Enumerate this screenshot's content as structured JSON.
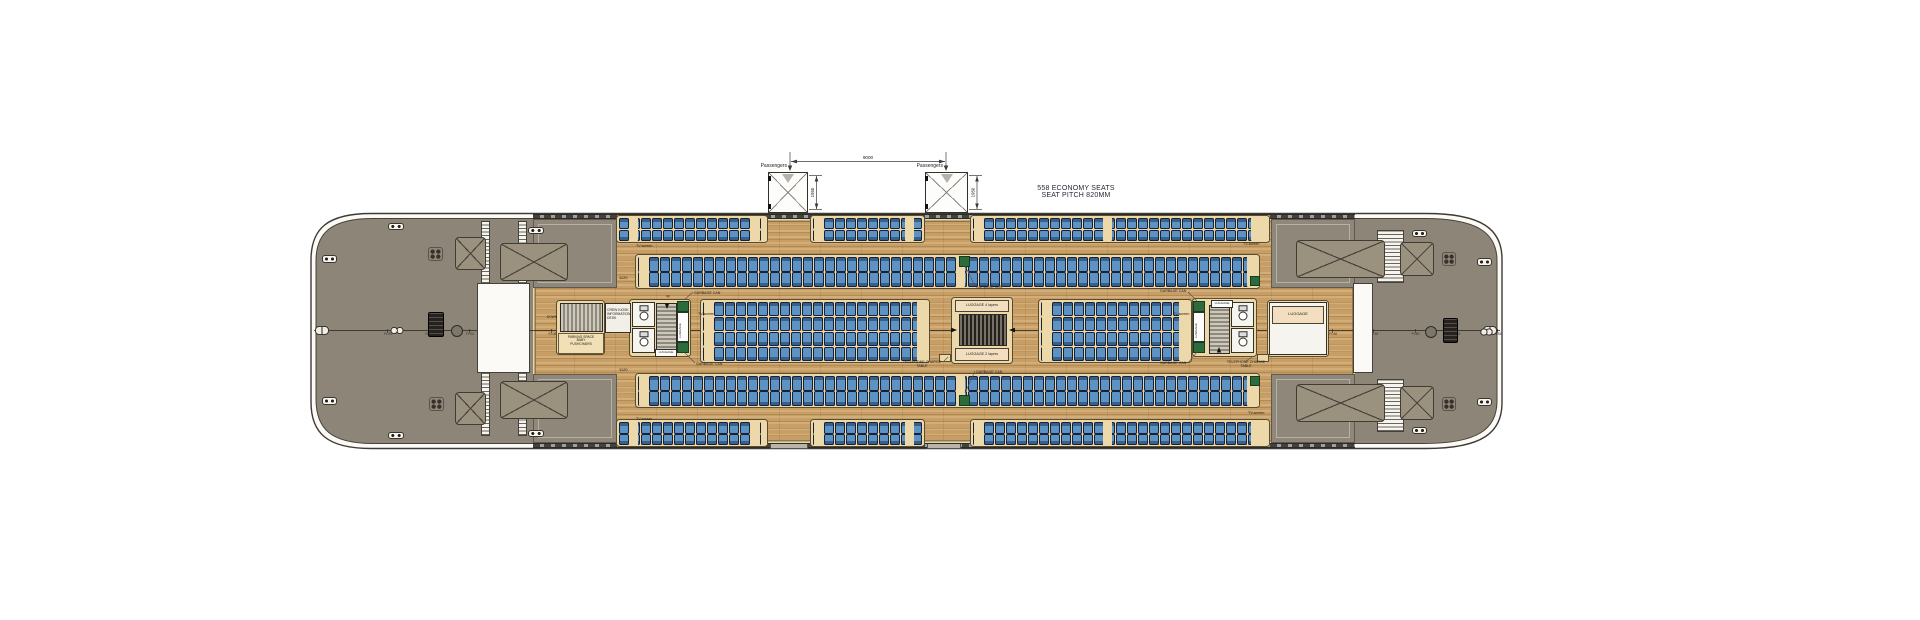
{
  "title": {
    "line1": "558 ECONOMY SEATS",
    "line2": "SEAT PITCH 820MM"
  },
  "dims": {
    "gangway_span": "9000",
    "door_width_left": "1950",
    "door_width_right": "1950",
    "passengers_left": "Passengers",
    "passengers_right": "Passengers",
    "row_offset_top": "1120",
    "row_offset_bottom": "1120"
  },
  "colors": {
    "deck_gray": "#8d8577",
    "wood": "#c79e66",
    "wood_trim": "#e9d6a6",
    "seat_blue": "#5d92c4",
    "seat_backrest": "#37618c",
    "seat_outline": "#16213a",
    "platform_cream": "#ecd8a8",
    "luggage_green": "#2c6b3c",
    "hull_line": "#3f3a33",
    "annotation": "#23211c"
  },
  "frames": {
    "prefix": "Fr.",
    "start": 0,
    "end": 54,
    "step": 2,
    "x0": 387,
    "pitch": 20.55,
    "tick_y": 328.6,
    "label_y": 331.8
  },
  "plan": {
    "canvas": {
      "w": 1920,
      "h": 620
    },
    "centerline": {
      "x": 314,
      "y": 330.3,
      "w": 1186
    },
    "wood_main": [
      533,
      219,
      822,
      224
    ],
    "corner_blocks": [
      [
        533,
        219,
        84,
        69
      ],
      [
        533,
        374,
        84,
        69
      ],
      [
        1271,
        219,
        84,
        69
      ],
      [
        1271,
        374,
        84,
        69
      ]
    ],
    "walls": [
      [
        533,
        213.5,
        822,
        5.5
      ],
      [
        533,
        442.5,
        822,
        5.5
      ]
    ],
    "towers": [
      {
        "x": 768,
        "y": 172,
        "w": 40,
        "h": 41
      },
      {
        "x": 925,
        "y": 172,
        "w": 43,
        "h": 41
      }
    ],
    "white_bands": [
      [
        477,
        283,
        53,
        90
      ],
      [
        1353,
        283,
        20,
        90
      ]
    ],
    "ladders": [
      [
        481,
        221,
        9,
        63
      ],
      [
        518,
        221,
        9,
        63
      ],
      [
        481,
        372,
        9,
        64
      ],
      [
        518,
        372,
        9,
        64
      ],
      [
        1377,
        230,
        27,
        53
      ],
      [
        1377,
        379,
        27,
        53
      ]
    ],
    "hatches": [
      [
        455,
        237,
        31,
        33
      ],
      [
        455,
        392,
        31,
        33
      ],
      [
        500,
        243,
        68,
        38
      ],
      [
        500,
        381,
        68,
        38
      ],
      [
        1296,
        240,
        89,
        38
      ],
      [
        1296,
        384,
        89,
        38
      ],
      [
        1400,
        242,
        34,
        34
      ],
      [
        1400,
        386,
        34,
        34
      ]
    ],
    "vents": [
      [
        428,
        247,
        15,
        14
      ],
      [
        429,
        397,
        15,
        14
      ],
      [
        1442,
        252,
        14,
        14
      ],
      [
        1442,
        397,
        14,
        14
      ]
    ],
    "cleats": [
      [
        322,
        255,
        15,
        8
      ],
      [
        322,
        397,
        15,
        8
      ],
      [
        388,
        223,
        16,
        7
      ],
      [
        528,
        227,
        16,
        7
      ],
      [
        388,
        432,
        16,
        7
      ],
      [
        528,
        430,
        16,
        7
      ],
      [
        1412,
        230,
        15,
        7
      ],
      [
        1477,
        258,
        15,
        8
      ],
      [
        1477,
        398,
        15,
        8
      ],
      [
        1412,
        427,
        15,
        7
      ]
    ],
    "fairleads": [
      [
        315,
        326,
        14,
        9
      ],
      [
        1483,
        326,
        14,
        9
      ]
    ],
    "capstans": [
      [
        428,
        312,
        16,
        25
      ],
      [
        1443,
        318,
        15,
        25
      ]
    ],
    "circles": [
      [
        451,
        325,
        12,
        12
      ],
      [
        1425,
        326,
        12,
        12
      ]
    ],
    "bollards": [
      [
        390,
        326,
        14,
        9
      ],
      [
        1480,
        328,
        13,
        8
      ]
    ],
    "thresholds": [
      [
        770,
        444,
        38,
        5
      ],
      [
        927,
        444,
        34,
        5
      ]
    ],
    "platforms": [
      [
        556,
        300,
        49,
        55
      ],
      [
        629,
        299,
        62,
        58
      ],
      [
        951,
        297,
        62,
        67
      ],
      [
        1192,
        298,
        65,
        59
      ],
      [
        1267,
        300,
        62,
        57
      ]
    ],
    "stairs": [
      {
        "x": 560,
        "y": 303,
        "w": 43,
        "h": 29,
        "dir": "h"
      },
      {
        "x": 656,
        "y": 303,
        "w": 21,
        "h": 48,
        "dir": "v"
      },
      {
        "x": 959,
        "y": 314,
        "w": 48,
        "h": 32,
        "dir": "h",
        "dark": true
      },
      {
        "x": 1209,
        "y": 305,
        "w": 21,
        "h": 49,
        "dir": "v"
      },
      {
        "x": 1281,
        "y": 327,
        "w": 43,
        "h": 27,
        "dir": "h"
      }
    ],
    "wc_rooms": [
      [
        632,
        302,
        23,
        25
      ],
      [
        632,
        328,
        23,
        25
      ],
      [
        1231,
        302,
        23,
        25
      ],
      [
        1231,
        328,
        23,
        25
      ]
    ],
    "kiosk": [
      605,
      303,
      26,
      30
    ],
    "parking_box": [
      558,
      333,
      46,
      21
    ],
    "luggage_room": [
      1269,
      302,
      58,
      53
    ],
    "luggage_header": [
      1272,
      306,
      52,
      18
    ],
    "luggage_boxes": [
      [
        955,
        300,
        54,
        12
      ],
      [
        955,
        348,
        54,
        13
      ]
    ],
    "luggage_chips": [
      [
        655,
        349,
        22,
        8
      ],
      [
        1211,
        300,
        22,
        8
      ]
    ],
    "luggage_strips": [
      {
        "x": 677,
        "y": 301,
        "w": 12,
        "h": 52
      },
      {
        "x": 1193,
        "y": 301,
        "w": 12,
        "h": 52
      }
    ],
    "greens": [
      [
        959,
        256,
        11,
        11
      ],
      [
        959,
        395,
        11,
        11
      ],
      [
        1250,
        276,
        10,
        10
      ],
      [
        1250,
        376,
        10,
        10
      ]
    ],
    "tables": [
      [
        939,
        354,
        12,
        8
      ],
      [
        1257,
        354,
        12,
        8
      ]
    ],
    "seat_geom": {
      "pitch": 10.35,
      "gap": 1.25,
      "pair_extra": 1.3
    },
    "seat_bands": [
      {
        "name": "window-top",
        "y": 217,
        "rows": 2,
        "rowD": 11.8,
        "segments": [
          [
            618,
            766
          ],
          [
            812,
            923
          ],
          [
            972,
            1268
          ]
        ],
        "accents": [
          629,
          751,
          814,
          905,
          974,
          1103,
          1251
        ]
      },
      {
        "name": "upper",
        "y": 256.5,
        "rows": 2,
        "rowD": 15,
        "segments": [
          [
            637,
            1258
          ]
        ],
        "accents": [
          639,
          956,
          1247
        ]
      },
      {
        "name": "center",
        "y": 301,
        "rows": 4,
        "rowD": 14.9,
        "segments": [
          [
            702,
            928
          ],
          [
            1040,
            1190
          ]
        ],
        "accents": [
          704,
          917,
          1042,
          1179
        ]
      },
      {
        "name": "lower",
        "y": 375.5,
        "rows": 2,
        "rowD": 15,
        "segments": [
          [
            637,
            1258
          ]
        ],
        "accents": [
          639,
          956,
          1247
        ]
      },
      {
        "name": "window-bottom",
        "y": 421.5,
        "rows": 2,
        "rowD": 11.8,
        "segments": [
          [
            618,
            766
          ],
          [
            812,
            923
          ],
          [
            972,
            1268
          ]
        ],
        "accents": [
          629,
          751,
          814,
          905,
          974,
          1103,
          1251
        ]
      }
    ],
    "labels": [
      {
        "t": "TV-screen",
        "x": 636,
        "y": 244,
        "s": 3.6
      },
      {
        "t": "TV-screen",
        "x": 698,
        "y": 312,
        "s": 3.6
      },
      {
        "t": "TV-screen",
        "x": 1173,
        "y": 312,
        "s": 3.6
      },
      {
        "t": "TV-screen",
        "x": 636,
        "y": 417,
        "s": 3.6
      },
      {
        "t": "TV-screen",
        "x": 1243,
        "y": 242,
        "s": 3.6
      },
      {
        "t": "TV-screen",
        "x": 1248,
        "y": 411,
        "s": 3.6
      },
      {
        "t": "GARBAGE CAN",
        "x": 694,
        "y": 291,
        "s": 3.6
      },
      {
        "t": "GARBAGE CAN",
        "x": 696,
        "y": 362,
        "s": 3.6
      },
      {
        "t": "GARBAGE CAN",
        "x": 976,
        "y": 285,
        "s": 3.6
      },
      {
        "t": "GARBAGE CAN",
        "x": 976,
        "y": 370,
        "s": 3.6
      },
      {
        "t": "GARBAGE CAN",
        "x": 1160,
        "y": 289,
        "s": 3.6
      },
      {
        "t": "GARBAGE CAN",
        "x": 1160,
        "y": 361,
        "s": 3.6
      },
      {
        "t": "TELEPHONE CHARGE\nTABLE",
        "x": 898,
        "y": 360,
        "s": 3.6,
        "w": 48,
        "al": "center"
      },
      {
        "t": "TELEPHONE CHARGE\nTABLE",
        "x": 1222,
        "y": 360,
        "s": 3.6,
        "w": 48,
        "al": "center"
      },
      {
        "t": "CREW KIOSK\nINFORMATION\nDESK",
        "x": 607,
        "y": 308,
        "s": 3.4,
        "w": 26
      },
      {
        "t": "PARKING SPACE\nBABY\nPUSHCHAIRS",
        "x": 559,
        "y": 335.5,
        "s": 3.3,
        "w": 44,
        "al": "center"
      },
      {
        "t": "LUGGAGE 4 layers",
        "x": 955,
        "y": 303,
        "s": 3.7,
        "w": 54,
        "al": "center"
      },
      {
        "t": "LUGGAGE 2 layers",
        "x": 955,
        "y": 352,
        "s": 3.7,
        "w": 54,
        "al": "center"
      },
      {
        "t": "LUGGAGE",
        "x": 1272,
        "y": 312,
        "s": 4,
        "w": 52,
        "al": "center"
      },
      {
        "t": "LUGGAGE",
        "x": 655,
        "y": 350.5,
        "s": 3,
        "w": 22,
        "al": "center"
      },
      {
        "t": "LUGGAGE",
        "x": 1211,
        "y": 301.5,
        "s": 3,
        "w": 22,
        "al": "center"
      },
      {
        "t": "LUGGAGE",
        "x": 679,
        "y": 338,
        "s": 3,
        "rot": true
      },
      {
        "t": "LUGGAGE",
        "x": 1195,
        "y": 338,
        "s": 3,
        "rot": true
      },
      {
        "t": "DOWN",
        "x": 547,
        "y": 315.5,
        "s": 3.2
      },
      {
        "t": "up",
        "x": 666,
        "y": 295,
        "s": 3.2
      },
      {
        "t": "1120",
        "x": 619,
        "y": 276,
        "s": 4
      },
      {
        "t": "1120",
        "x": 619,
        "y": 368,
        "s": 4
      }
    ]
  }
}
